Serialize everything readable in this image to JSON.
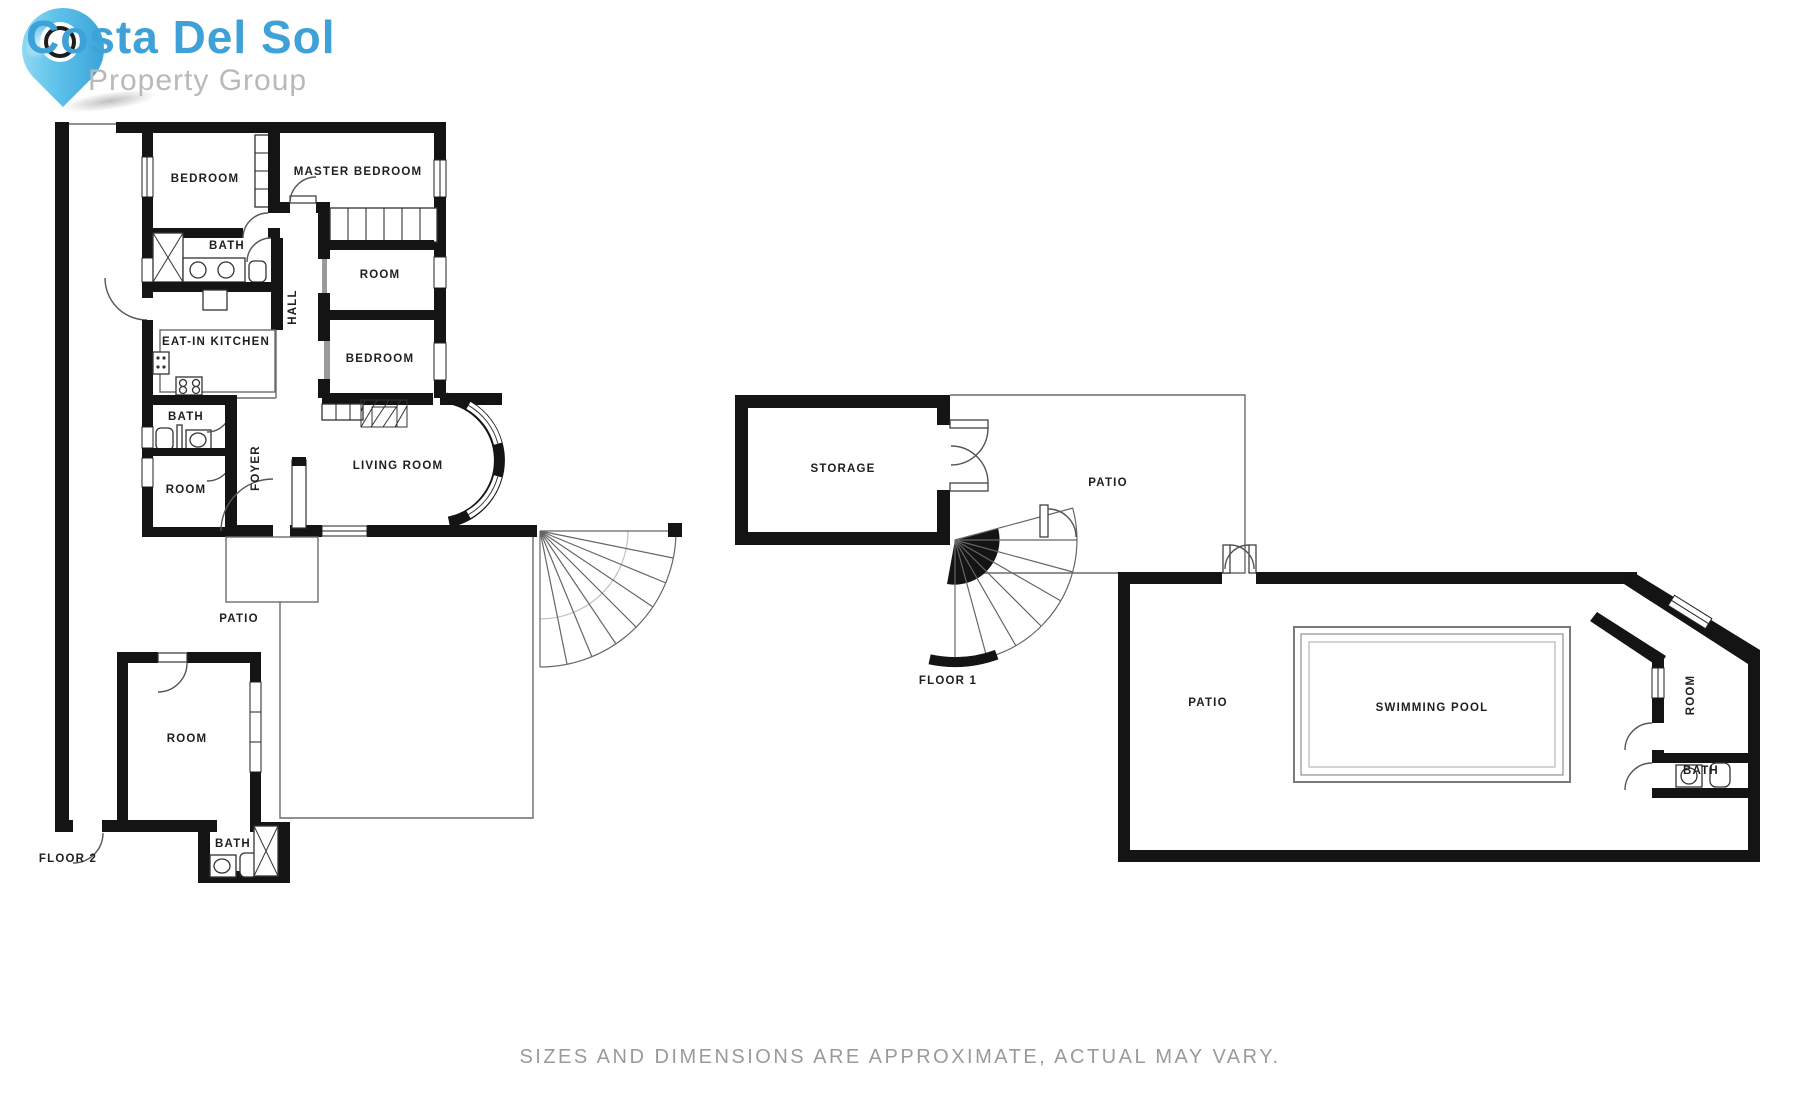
{
  "logo": {
    "brand": "Costa Del Sol",
    "tagline": "Property Group",
    "icon": "map-pin-icon",
    "brand_color": "#3ea2d8",
    "tagline_color": "#b9b9b9",
    "pin_color": "#2d9ad3"
  },
  "disclaimer": "SIZES AND DIMENSIONS ARE APPROXIMATE, ACTUAL MAY VARY.",
  "colors": {
    "wall": "#141414",
    "thin_line": "#6b6b6b",
    "label": "#1f1f1f"
  },
  "floor2": {
    "floor_label": "FLOOR 2",
    "rooms": {
      "bedroom1": "BEDROOM",
      "master_bedroom": "MASTER BEDROOM",
      "bath_top": "BATH",
      "room_right": "ROOM",
      "hall": "HALL",
      "kitchen": "EAT-IN KITCHEN",
      "bedroom_right": "BEDROOM",
      "bath_mid": "BATH",
      "foyer": "FOYER",
      "living_room": "LIVING ROOM",
      "room_mid": "ROOM",
      "patio": "PATIO",
      "room_bottom": "ROOM",
      "bath_bottom": "BATH"
    }
  },
  "floor1": {
    "floor_label": "FLOOR 1",
    "rooms": {
      "storage": "STORAGE",
      "patio_upper": "PATIO",
      "patio_pool": "PATIO",
      "swimming_pool": "SWIMMING POOL",
      "room": "ROOM",
      "bath": "BATH"
    }
  }
}
